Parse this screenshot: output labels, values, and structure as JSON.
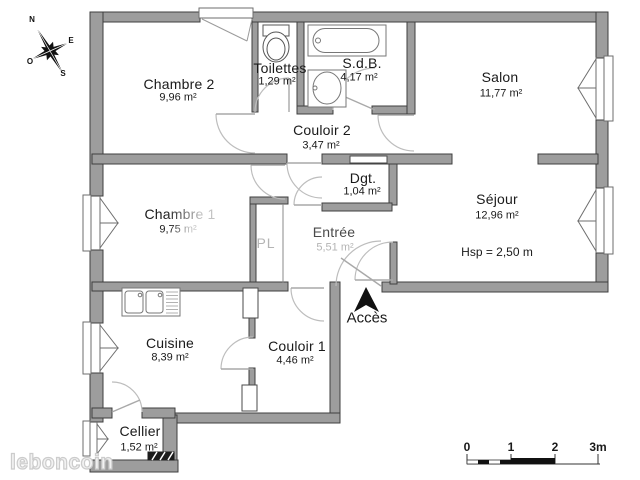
{
  "compass": {
    "n": "N",
    "e": "E",
    "s": "S",
    "o": "O"
  },
  "rooms": [
    {
      "name": "Chambre 2",
      "area": "9,96 m²"
    },
    {
      "name": "Toilettes",
      "area": "1,29 m²"
    },
    {
      "name": "S.d.B.",
      "area": "4,17 m²"
    },
    {
      "name": "Salon",
      "area": "11,77 m²"
    },
    {
      "name": "Couloir 2",
      "area": "3,47 m²"
    },
    {
      "name": "Chambre 1",
      "area": "9,75 m²"
    },
    {
      "name": "Dgt.",
      "area": "1,04 m²"
    },
    {
      "name": "Séjour",
      "area": "12,96 m²"
    },
    {
      "name": "Entrée",
      "area": "5,51 m²"
    },
    {
      "name": "Cuisine",
      "area": "8,39 m²"
    },
    {
      "name": "Couloir 1",
      "area": "4,46 m²"
    },
    {
      "name": "Cellier",
      "area": "1,52 m²"
    }
  ],
  "annotations": {
    "ceiling_height": "Hsp = 2,50 m",
    "closet": "PL",
    "access": "Accès"
  },
  "scale_bar": {
    "ticks": [
      "0",
      "1",
      "2",
      "3m"
    ]
  },
  "watermark": "leboncoin",
  "colors": {
    "wall": "#9d9d9d",
    "wall_edge": "#3f3f3f",
    "door_arc": "#bdbdbd",
    "text": "#1a1a1a",
    "muted_text": "#b4b4b4",
    "watermark": "#cccccc"
  }
}
